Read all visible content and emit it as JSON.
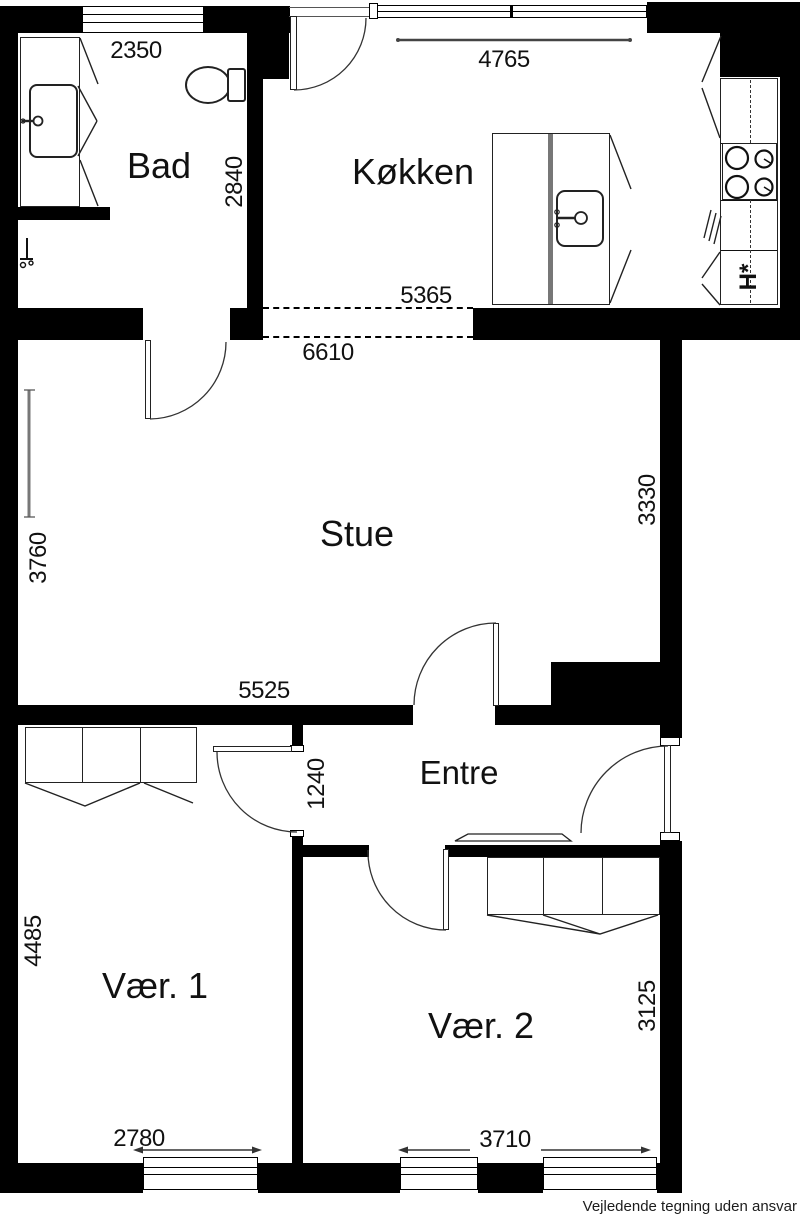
{
  "document": {
    "footer_disclaimer": "Vejledende tegning uden ansvar"
  },
  "rooms": {
    "bad": {
      "label": "Bad"
    },
    "kokken": {
      "label": "Køkken"
    },
    "stue": {
      "label": "Stue"
    },
    "entre": {
      "label": "Entre"
    },
    "vaer1": {
      "label": "Vær. 1"
    },
    "vaer2": {
      "label": "Vær. 2"
    }
  },
  "dimensions_mm": {
    "bad_width": "2350",
    "bad_depth": "2840",
    "kokken_width": "4765",
    "kokken_opening": "5365",
    "stue_width": "6610",
    "stue_right_depth": "3330",
    "stue_left_depth": "3760",
    "stue_bottom_width": "5525",
    "entre_depth": "1240",
    "vaer1_depth": "4485",
    "vaer1_window_width": "2780",
    "vaer2_window_width": "3710",
    "vaer2_depth": "3125"
  },
  "kitchen": {
    "appliance_label": "H*"
  },
  "icons": [
    "toilet-icon",
    "bathroom-sink-icon",
    "shower-valve-icon",
    "kitchen-sink-icon",
    "stove-icon",
    "wardrobe-icon",
    "doormat-icon",
    "door-swing-icon",
    "window-icon",
    "radiator-dimension-line"
  ],
  "colors": {
    "wall": "#000000",
    "background": "#ffffff",
    "line": "#1a1a1a",
    "dim_line": "#555555"
  }
}
